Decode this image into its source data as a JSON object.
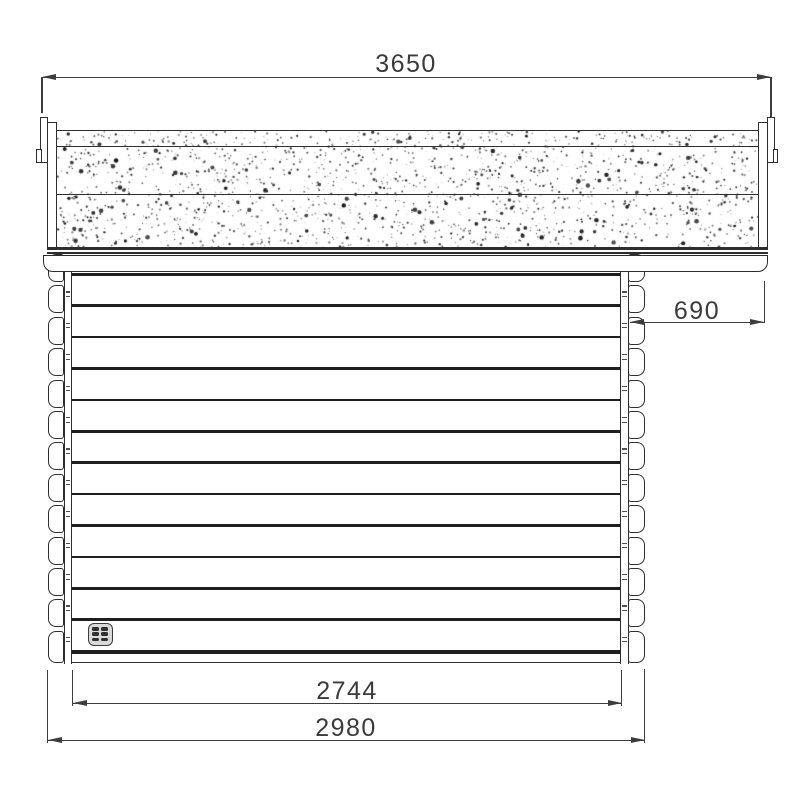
{
  "dimensions": {
    "roof_width": "3650",
    "right_overhang": "690",
    "wall_width_inner": "2744",
    "wall_width_outer": "2980"
  },
  "drawing": {
    "line_color": "#2e2e2e",
    "dim_color": "#3d3d3d",
    "text_color": "#3a3a3a",
    "speckle_color": "#161616",
    "log_courses": 13,
    "log_pitch_px": 31.4,
    "corner_log_ends_rows": 13,
    "roof_texture_layers": 3,
    "vent_slat_rows": 3,
    "vent_slat_cols": 2
  }
}
